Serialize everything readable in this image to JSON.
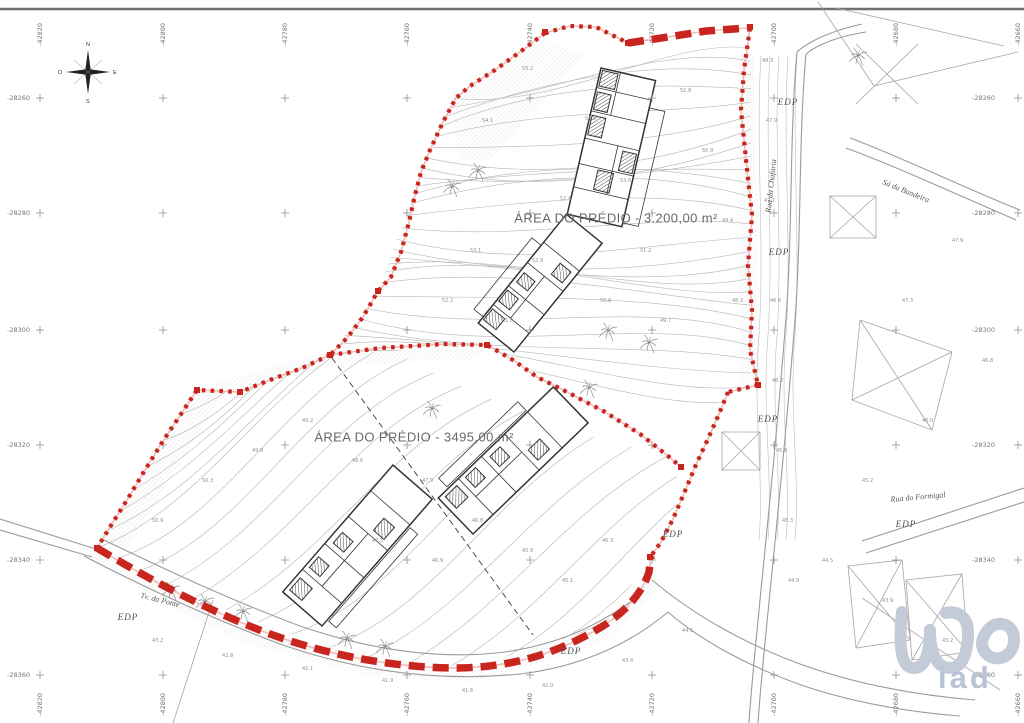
{
  "colors": {
    "boundary_red": "#c9251f",
    "halo_pink": "#f0bcb8",
    "contour_gray": "#b5b5b5",
    "road_gray": "#9a9a9a",
    "label_gray": "#6a6a6a",
    "logo_blue": "#bfc8d6"
  },
  "area_labels": [
    {
      "text": "ÁREA DO PRÉDIO - 3.200,00 m²",
      "x": 616,
      "y": 218
    },
    {
      "text": "ÁREA DO PRÉDIO - 3495,00 m²",
      "x": 414,
      "y": 437
    }
  ],
  "street_labels": [
    {
      "text": "Rua da Chafaria",
      "x": 771,
      "y": 186,
      "rotate": -84
    },
    {
      "text": "Rua do Formigal",
      "x": 918,
      "y": 497,
      "rotate": -5
    },
    {
      "text": "Sá da Bandeira",
      "x": 906,
      "y": 191,
      "rotate": 22
    },
    {
      "text": "Tv. da Ponte",
      "x": 160,
      "y": 600,
      "rotate": 14
    }
  ],
  "utility_label": "EDP",
  "utility_positions": [
    {
      "x": 128,
      "y": 617
    },
    {
      "x": 788,
      "y": 102
    },
    {
      "x": 779,
      "y": 252
    },
    {
      "x": 768,
      "y": 419
    },
    {
      "x": 673,
      "y": 534
    },
    {
      "x": 906,
      "y": 524
    },
    {
      "x": 571,
      "y": 651
    }
  ],
  "compass": {
    "north": "N",
    "south": "S",
    "east": "E",
    "west": "O"
  },
  "grid": {
    "columns": [
      {
        "x": 40,
        "label": "-42820"
      },
      {
        "x": 163,
        "label": "-42800"
      },
      {
        "x": 285,
        "label": "-42780"
      },
      {
        "x": 407,
        "label": "-42760"
      },
      {
        "x": 530,
        "label": "-42740"
      },
      {
        "x": 652,
        "label": "-42720"
      },
      {
        "x": 774,
        "label": "-42700"
      },
      {
        "x": 896,
        "label": "-42680"
      },
      {
        "x": 1018,
        "label": "-42660"
      }
    ],
    "rows": [
      {
        "y": 98,
        "label": "-28260"
      },
      {
        "y": 213,
        "label": "-28280"
      },
      {
        "y": 330,
        "label": "-28300"
      },
      {
        "y": 445,
        "label": "-28320"
      },
      {
        "y": 560,
        "label": "-28340"
      },
      {
        "y": 675,
        "label": "-28360"
      }
    ]
  },
  "logo": {
    "text": "iad"
  },
  "trees": [
    [
      478,
      171
    ],
    [
      452,
      187
    ],
    [
      432,
      409
    ],
    [
      608,
      331
    ],
    [
      649,
      343
    ],
    [
      589,
      388
    ],
    [
      347,
      639
    ],
    [
      385,
      647
    ],
    [
      205,
      602
    ],
    [
      243,
      612
    ],
    [
      171,
      590
    ],
    [
      858,
      56
    ]
  ],
  "spot_elevations": [
    {
      "x": 585,
      "y": 120,
      "v": "54.6"
    },
    {
      "x": 620,
      "y": 182,
      "v": "53.6"
    },
    {
      "x": 560,
      "y": 200,
      "v": "52.4"
    },
    {
      "x": 640,
      "y": 252,
      "v": "51.2"
    },
    {
      "x": 532,
      "y": 262,
      "v": "52.9"
    },
    {
      "x": 600,
      "y": 302,
      "v": "50.8"
    },
    {
      "x": 660,
      "y": 322,
      "v": "49.7"
    },
    {
      "x": 502,
      "y": 322,
      "v": "51.6"
    },
    {
      "x": 470,
      "y": 252,
      "v": "53.1"
    },
    {
      "x": 442,
      "y": 302,
      "v": "52.2"
    },
    {
      "x": 522,
      "y": 70,
      "v": "55.2"
    },
    {
      "x": 482,
      "y": 122,
      "v": "54.1"
    },
    {
      "x": 680,
      "y": 92,
      "v": "52.8"
    },
    {
      "x": 702,
      "y": 152,
      "v": "50.9"
    },
    {
      "x": 722,
      "y": 222,
      "v": "49.4"
    },
    {
      "x": 732,
      "y": 302,
      "v": "48.2"
    },
    {
      "x": 762,
      "y": 62,
      "v": "48.3"
    },
    {
      "x": 766,
      "y": 122,
      "v": "47.9"
    },
    {
      "x": 764,
      "y": 202,
      "v": "47.1"
    },
    {
      "x": 770,
      "y": 302,
      "v": "46.6"
    },
    {
      "x": 772,
      "y": 382,
      "v": "46.2"
    },
    {
      "x": 776,
      "y": 452,
      "v": "45.8"
    },
    {
      "x": 782,
      "y": 522,
      "v": "45.3"
    },
    {
      "x": 788,
      "y": 582,
      "v": "44.9"
    },
    {
      "x": 302,
      "y": 422,
      "v": "49.2"
    },
    {
      "x": 352,
      "y": 462,
      "v": "48.6"
    },
    {
      "x": 422,
      "y": 482,
      "v": "47.9"
    },
    {
      "x": 472,
      "y": 522,
      "v": "46.8"
    },
    {
      "x": 522,
      "y": 552,
      "v": "45.9"
    },
    {
      "x": 562,
      "y": 582,
      "v": "45.1"
    },
    {
      "x": 602,
      "y": 542,
      "v": "46.3"
    },
    {
      "x": 252,
      "y": 452,
      "v": "49.8"
    },
    {
      "x": 202,
      "y": 482,
      "v": "50.3"
    },
    {
      "x": 152,
      "y": 522,
      "v": "50.9"
    },
    {
      "x": 432,
      "y": 562,
      "v": "46.9"
    },
    {
      "x": 372,
      "y": 542,
      "v": "47.5"
    },
    {
      "x": 152,
      "y": 642,
      "v": "43.2"
    },
    {
      "x": 222,
      "y": 657,
      "v": "42.8"
    },
    {
      "x": 302,
      "y": 670,
      "v": "42.1"
    },
    {
      "x": 382,
      "y": 682,
      "v": "41.9"
    },
    {
      "x": 462,
      "y": 692,
      "v": "41.6"
    },
    {
      "x": 542,
      "y": 687,
      "v": "42.0"
    },
    {
      "x": 622,
      "y": 662,
      "v": "43.4"
    },
    {
      "x": 682,
      "y": 632,
      "v": "44.1"
    },
    {
      "x": 822,
      "y": 562,
      "v": "44.5"
    },
    {
      "x": 882,
      "y": 602,
      "v": "43.9"
    },
    {
      "x": 942,
      "y": 642,
      "v": "43.2"
    },
    {
      "x": 862,
      "y": 482,
      "v": "45.2"
    },
    {
      "x": 922,
      "y": 422,
      "v": "46.0"
    },
    {
      "x": 982,
      "y": 362,
      "v": "46.8"
    },
    {
      "x": 902,
      "y": 302,
      "v": "47.3"
    },
    {
      "x": 952,
      "y": 242,
      "v": "47.9"
    }
  ]
}
